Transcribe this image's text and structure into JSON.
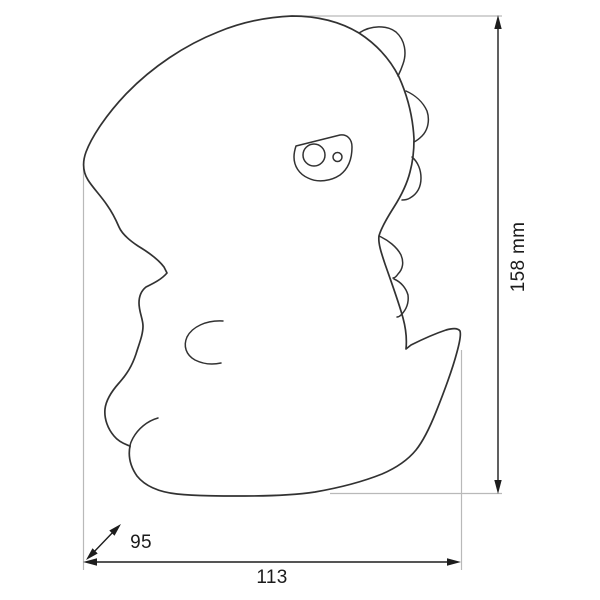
{
  "dimensions": {
    "height": "158 mm",
    "width": "113",
    "depth": "95"
  },
  "colors": {
    "background": "#ffffff",
    "outline": "#323232",
    "dimension_line": "#1d1d1d",
    "extension_line": "#b9b9b9",
    "label_text": "#1b1b1b"
  }
}
